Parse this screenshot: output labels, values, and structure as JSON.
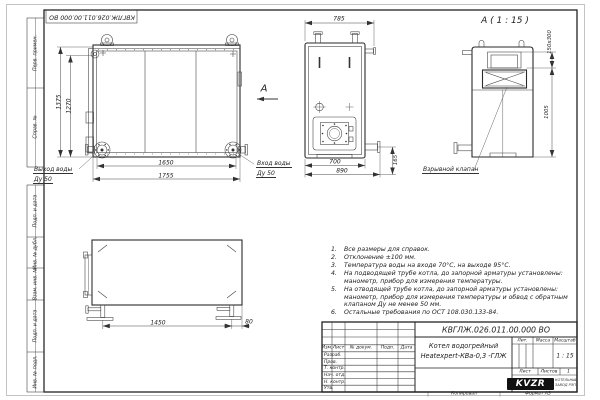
{
  "colors": {
    "line": "#333333",
    "paper": "#ffffff",
    "logo_bg": "#111111"
  },
  "frame": {
    "top_doc_number": "КВГЛЖ.026.011.00.000 ВО",
    "stamps": {
      "perv_primen": "Перв. примен.",
      "sprav_no": "Справ. №",
      "podp_data_1": "Подп. и дата",
      "inv_dubl": "Инв. № дубл.",
      "vzam_inv": "Взам. инв. №",
      "podp_data_2": "Подп. и дата",
      "inv_podl": "Инв. № подл."
    },
    "footer": {
      "copied": "Копировал",
      "format": "Формат А3"
    }
  },
  "views": {
    "front": {
      "dim_height_outer": "1375",
      "dim_height_inner": "1270",
      "dim_width_inner": "1650",
      "dim_width_outer": "1755",
      "label_outlet_line1": "Выход воды",
      "label_outlet_line2": "Ду 50",
      "label_inlet_line1": "Вход воды",
      "label_inlet_line2": "Ду 50",
      "view_arrow_label": "А"
    },
    "side": {
      "dim_top_width": "785",
      "dim_bottom_inner": "700",
      "dim_bottom_outer": "890",
      "dim_flange_height": "165"
    },
    "detail_a": {
      "title": "А ( 1 : 15 )",
      "dim_valve": "150x300",
      "dim_height": "1005",
      "valve_label": "Взрывной клапан"
    },
    "bottom": {
      "dim_leg_span": "1450",
      "dim_leg_offset": "80"
    }
  },
  "notes": {
    "items": [
      {
        "num": "1.",
        "text": "Все размеры для справок."
      },
      {
        "num": "2.",
        "text": "Отклонение ±100 мм."
      },
      {
        "num": "3.",
        "text": "Температура воды на входе 70°С, на выходе 95°С."
      },
      {
        "num": "4.",
        "text": "На подводящей трубе котла, до запорной арматуры установлены: манометр, прибор для измерения температуры."
      },
      {
        "num": "5.",
        "text": "На отводящей трубе котла, до запорной арматуры установлены: манометр, прибор для измерения температуры и обвод с обратным клапаном Ду не менее 50 мм."
      },
      {
        "num": "6.",
        "text": "Остальные требования по ОСТ 108.030.133-84."
      }
    ]
  },
  "title_block": {
    "doc_number": "КВГЛЖ.026.011.00.000 ВО",
    "product_title_line1": "Котел водогрейный",
    "product_title_line2": "Heatexpert-КВа-0,3 -ГЛЖ",
    "col_lit": "Лит.",
    "col_mass": "Масса",
    "col_scale": "Масштаб",
    "scale_value": "1 : 15",
    "sheet_label": "Лист",
    "sheets_label": "Листов",
    "sheets_value": "1",
    "sig_cols": {
      "izm": "Изм.",
      "list": "Лист",
      "doc": "№ докум.",
      "podp": "Подп.",
      "data": "Дата"
    },
    "sig_rows": [
      "Разраб.",
      "Пров.",
      "Т. контр.",
      "Нач. отд.",
      "Н. контр.",
      "Утв."
    ],
    "logo_text": "KVZR",
    "company_line1": "КОТЕЛЬНЫЙ",
    "company_line2": "ЗАВОД РЭП"
  }
}
